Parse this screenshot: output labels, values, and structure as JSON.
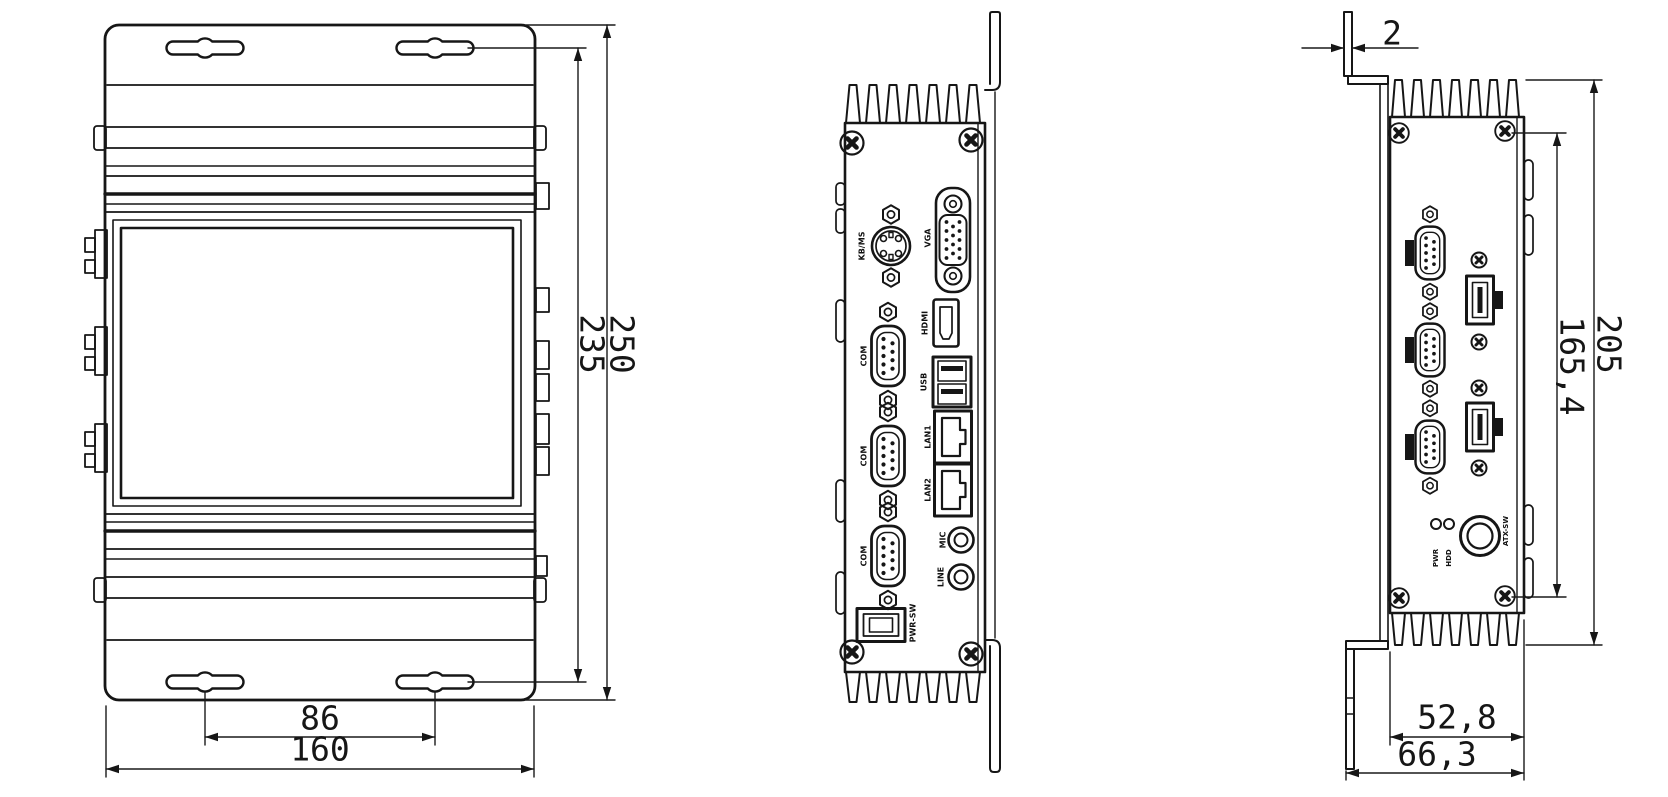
{
  "drawing_colors": {
    "line": "#161616",
    "background": "#ffffff"
  },
  "views": {
    "top": {
      "dims": {
        "total_height": "250",
        "mount_slot_span": "235",
        "slot_spacing": "86",
        "total_width": "160"
      }
    },
    "rear": {
      "ports": {
        "ps2": "KB/MS",
        "vga": "VGA",
        "hdmi": "HDMI",
        "usb": "USB",
        "lan1": "LAN1",
        "lan2": "LAN2",
        "mic": "MIC",
        "line_out": "LINE",
        "com1": "COM",
        "com2": "COM",
        "com3": "COM",
        "power_switch": "PWR-SW"
      }
    },
    "front": {
      "dims": {
        "bracket_thickness": "2",
        "mount_hole_span": "165,4",
        "body_height": "205",
        "body_depth": "52,8",
        "overall_depth": "66,3"
      },
      "labels": {
        "power_button": "ATX-SW",
        "led_power": "PWR",
        "led_hdd": "HDD"
      }
    }
  }
}
